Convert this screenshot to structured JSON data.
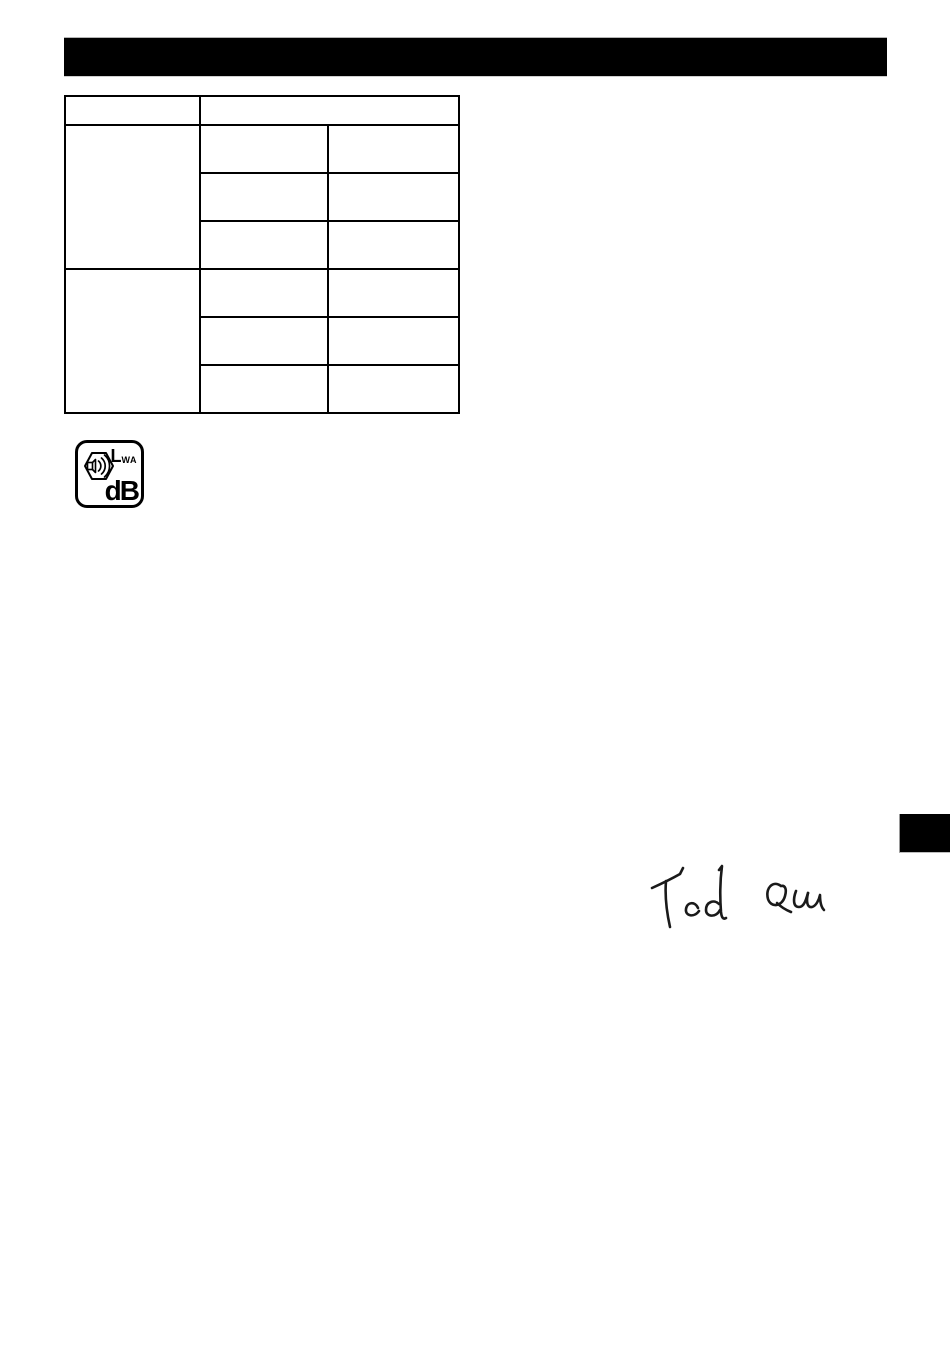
{
  "header_bar": {
    "fill_color": "#000000"
  },
  "spec_table": {
    "header_left": "",
    "header_right": "",
    "group1": {
      "label": "",
      "rows": [
        [
          "",
          ""
        ],
        [
          "",
          ""
        ],
        [
          "",
          ""
        ]
      ]
    },
    "group2": {
      "label": "",
      "rows": [
        [
          "",
          ""
        ],
        [
          "",
          ""
        ],
        [
          "",
          ""
        ]
      ]
    }
  },
  "noise_badge": {
    "lwa_main": "L",
    "lwa_sub": "WA",
    "db_label": "dB",
    "icon": "speaker-sound-waves-icon",
    "border_color": "#000000"
  },
  "signature": {
    "text": "Ted Qu",
    "ink_color": "#1a1a1a"
  },
  "redaction_tab": {
    "fill_color": "#000000"
  }
}
